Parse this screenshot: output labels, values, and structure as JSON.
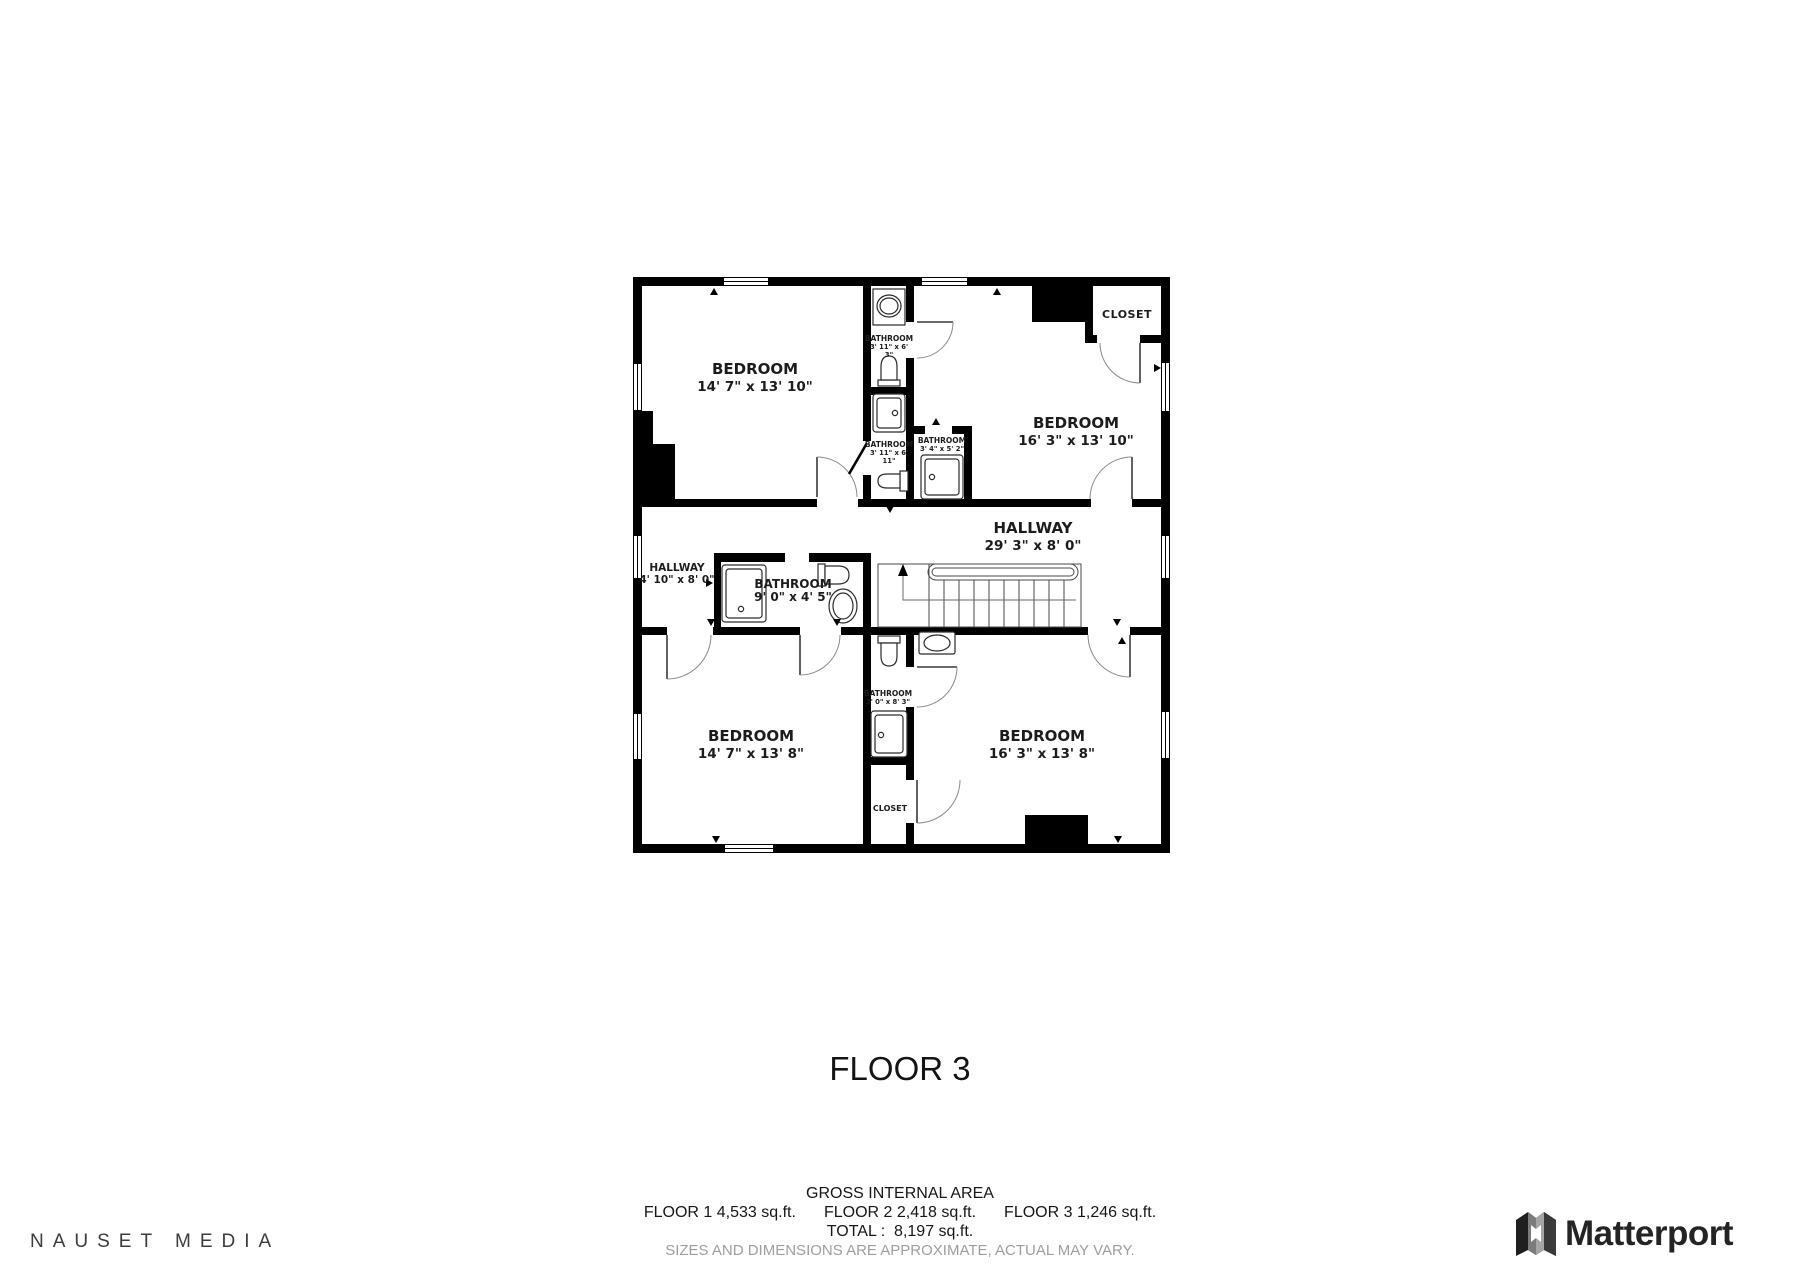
{
  "title": {
    "floor_label": "FLOOR 3"
  },
  "footer": {
    "gross_label": "GROSS INTERNAL AREA",
    "floor_areas": [
      {
        "label": "FLOOR 1",
        "value": "4,533 sq.ft."
      },
      {
        "label": "FLOOR 2",
        "value": "2,418 sq.ft."
      },
      {
        "label": "FLOOR 3",
        "value": "1,246 sq.ft."
      }
    ],
    "total_label": "TOTAL :",
    "total_value": "8,197 sq.ft.",
    "disclaimer": "SIZES AND DIMENSIONS ARE APPROXIMATE, ACTUAL MAY VARY."
  },
  "branding": {
    "left_logo": "NAUSET MEDIA",
    "right_logo": "Matterport"
  },
  "colors": {
    "wall": "#000000",
    "label_text": "#1c1c1c",
    "door_arc": "#8a8a8a",
    "fixture_stroke": "#2a2a2a",
    "disclaimer_gray": "#9e9e9e",
    "nauset_gray": "#3c3c3c",
    "matterport_dark": "#242424"
  },
  "floorplan": {
    "labels": [
      {
        "text": "BEDROOM",
        "x": 122,
        "y": 97,
        "cls": "t-room"
      },
      {
        "text": "14' 7\" x 13' 10\"",
        "x": 122,
        "y": 114,
        "cls": "t-dim"
      },
      {
        "text": "BEDROOM",
        "x": 443,
        "y": 151,
        "cls": "t-room"
      },
      {
        "text": "16' 3\" x 13' 10\"",
        "x": 443,
        "y": 168,
        "cls": "t-dim"
      },
      {
        "text": "BEDROOM",
        "x": 118,
        "y": 464,
        "cls": "t-room"
      },
      {
        "text": "14' 7\" x 13' 8\"",
        "x": 118,
        "y": 481,
        "cls": "t-dim"
      },
      {
        "text": "BEDROOM",
        "x": 409,
        "y": 464,
        "cls": "t-room"
      },
      {
        "text": "16' 3\" x 13' 8\"",
        "x": 409,
        "y": 481,
        "cls": "t-dim"
      },
      {
        "text": "HALLWAY",
        "x": 400,
        "y": 256,
        "cls": "t-room"
      },
      {
        "text": "29' 3\" x 8' 0\"",
        "x": 400,
        "y": 273,
        "cls": "t-dim"
      },
      {
        "text": "HALLWAY",
        "x": 44,
        "y": 294,
        "cls": "t-small"
      },
      {
        "text": "4' 10\" x 8' 0\"",
        "x": 44,
        "y": 306,
        "cls": "t-small"
      },
      {
        "text": "BATHROOM",
        "x": 160,
        "y": 311,
        "cls": "t-med"
      },
      {
        "text": "9' 0\" x 4' 5\"",
        "x": 160,
        "y": 324,
        "cls": "t-med"
      },
      {
        "text": "BATHROOM",
        "x": 256,
        "y": 64,
        "cls": "t-tiny"
      },
      {
        "text": "3' 11\" x 6'",
        "x": 256,
        "y": 72,
        "cls": "t-tiny2"
      },
      {
        "text": "3\"",
        "x": 256,
        "y": 80,
        "cls": "t-tiny2"
      },
      {
        "text": "BATHROOM",
        "x": 256,
        "y": 170,
        "cls": "t-tiny"
      },
      {
        "text": "3' 11\" x 6'",
        "x": 256,
        "y": 178,
        "cls": "t-tiny2"
      },
      {
        "text": "11\"",
        "x": 256,
        "y": 186,
        "cls": "t-tiny2"
      },
      {
        "text": "BATHROOM",
        "x": 309,
        "y": 166,
        "cls": "t-tiny"
      },
      {
        "text": "3' 4\" x 5' 2\"",
        "x": 309,
        "y": 174,
        "cls": "t-tiny2"
      },
      {
        "text": "BATHROOM",
        "x": 255,
        "y": 419,
        "cls": "t-tiny"
      },
      {
        "text": "3' 0\" x 8' 3\"",
        "x": 255,
        "y": 427,
        "cls": "t-tiny2"
      },
      {
        "text": "CLOSET",
        "x": 494,
        "y": 41,
        "cls": "t-closet"
      },
      {
        "text": "CLOSET",
        "x": 257,
        "y": 534,
        "cls": "t-clsmall"
      }
    ]
  }
}
